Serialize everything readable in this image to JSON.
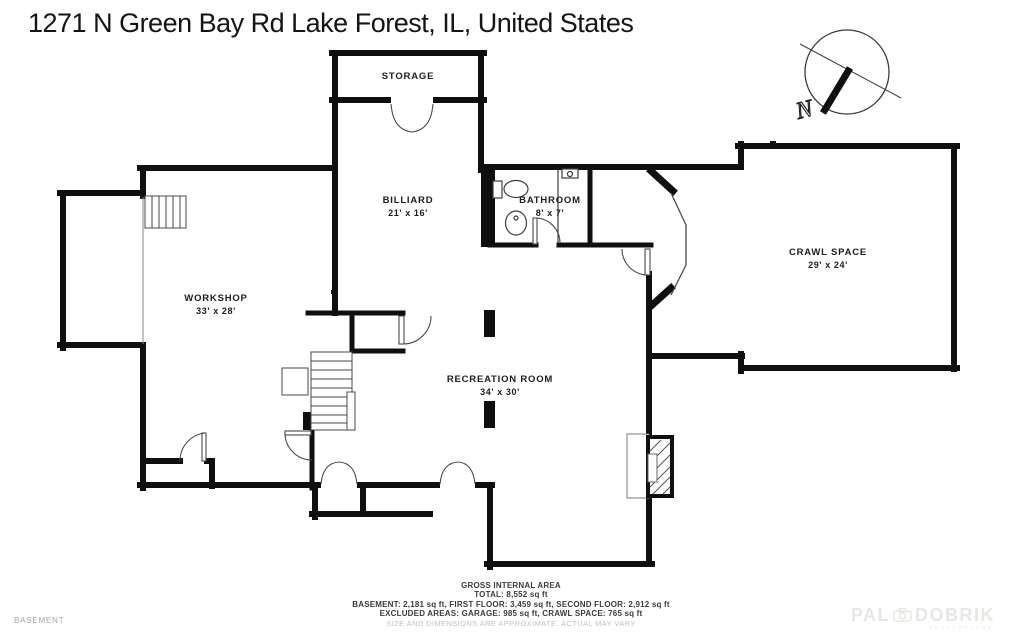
{
  "title": "1271 N Green Bay Rd Lake Forest, IL, United States",
  "floor_label": "BASEMENT",
  "compass": {
    "north_label": "N"
  },
  "rooms": {
    "storage": {
      "name": "STORAGE",
      "dims": ""
    },
    "billiard": {
      "name": "BILLIARD",
      "dims": "21' x 16'"
    },
    "bathroom": {
      "name": "BATHROOM",
      "dims": "8' x 7'"
    },
    "crawl_space": {
      "name": "CRAWL SPACE",
      "dims": "29' x 24'"
    },
    "workshop": {
      "name": "WORKSHOP",
      "dims": "33' x 28'"
    },
    "recreation": {
      "name": "RECREATION ROOM",
      "dims": "34' x 30'"
    }
  },
  "summary": {
    "heading": "GROSS INTERNAL AREA",
    "total": "TOTAL: 8,552 sq ft",
    "floors": "BASEMENT: 2,181 sq ft, FIRST FLOOR: 3,459 sq ft, SECOND FLOOR: 2,912 sq ft",
    "excluded": "EXCLUDED AREAS: GARAGE: 985 sq ft, CRAWL SPACE: 765 sq ft",
    "disclaimer": "SIZE AND DIMENSIONS ARE APPROXIMATE. ACTUAL MAY VARY"
  },
  "watermark": {
    "brand_left": "PAL",
    "brand_right": "DOBRIK",
    "tagline": "PHOTOGRAPHY"
  },
  "colors": {
    "wall": "#0f0f0f",
    "thin_line": "#4a4a4a",
    "label": "#1d1d1d",
    "muted": "#a9a8a6",
    "watermark": "#e9e7e4"
  }
}
